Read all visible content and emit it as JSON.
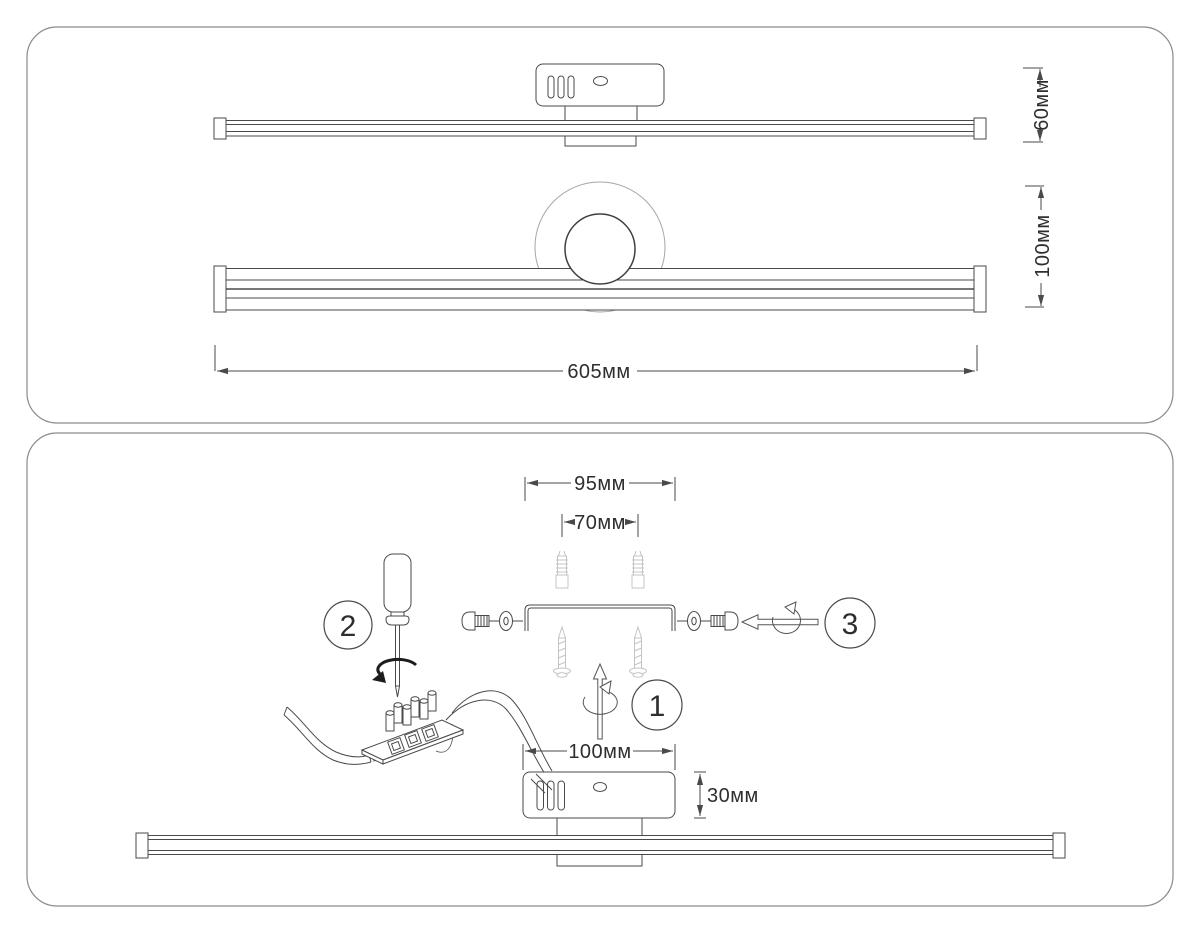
{
  "diagram": {
    "top_panel": {
      "dim_depth": "60мм",
      "dim_height": "100мм",
      "dim_length": "605мм"
    },
    "bottom_panel": {
      "dim_bracket_width": "95мм",
      "dim_hole_spacing": "70мм",
      "dim_canopy_width": "100мм",
      "dim_canopy_height": "30мм",
      "step_1": "1",
      "step_2": "2",
      "step_3": "3"
    },
    "colors": {
      "ink": "#4a4a4a",
      "light_line": "#a6a6a6",
      "hardware_gray": "#c4c4c4",
      "panel_border": "#8a8a8a",
      "background": "#ffffff"
    }
  }
}
